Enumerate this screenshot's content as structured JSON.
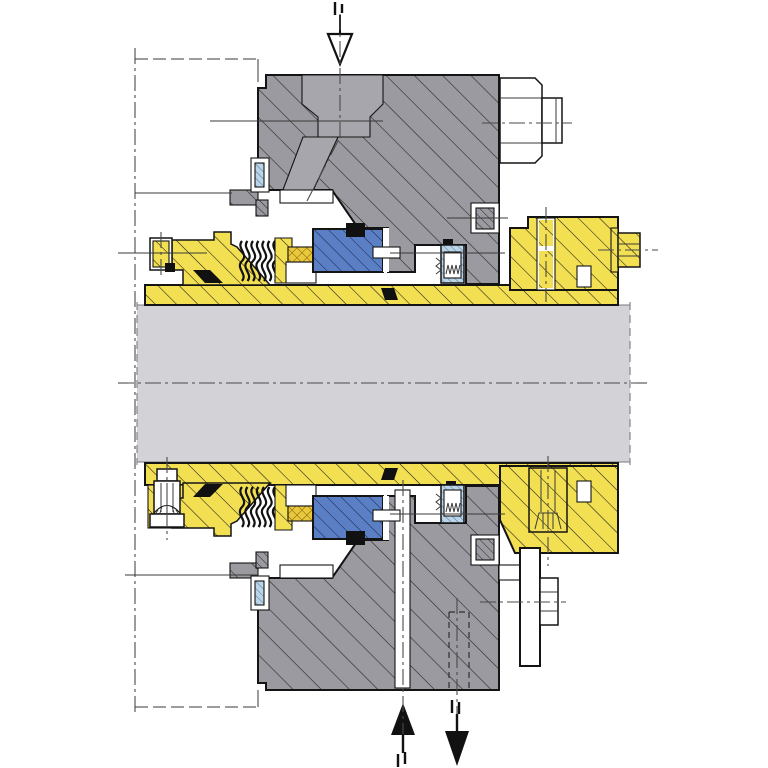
{
  "title": "mechanical-seal-cartridge-cross-section",
  "colors": {
    "background": "#ffffff",
    "outline": "#141414",
    "shaft": "#d3d2d6",
    "housing": "#9b9aa0",
    "housing_recess": "#a7a6ac",
    "sleeve_yellow": "#f3e052",
    "seal_face_blue": "#5b7fc4",
    "pusher_light_blue": "#bad4e8",
    "elastomer_gold": "#e9c83d",
    "white_part": "#ffffff",
    "black_part": "#111111",
    "centerline": "#4a4a4a",
    "leader": "#3a3a3a"
  },
  "symbols": {
    "top_port_arrow": "hollow-arrow-down",
    "flush_inlet_arrow": "solid-arrow-up",
    "flush_outlet_arrow": "solid-arrow-down",
    "port_marks": "double-bar"
  }
}
